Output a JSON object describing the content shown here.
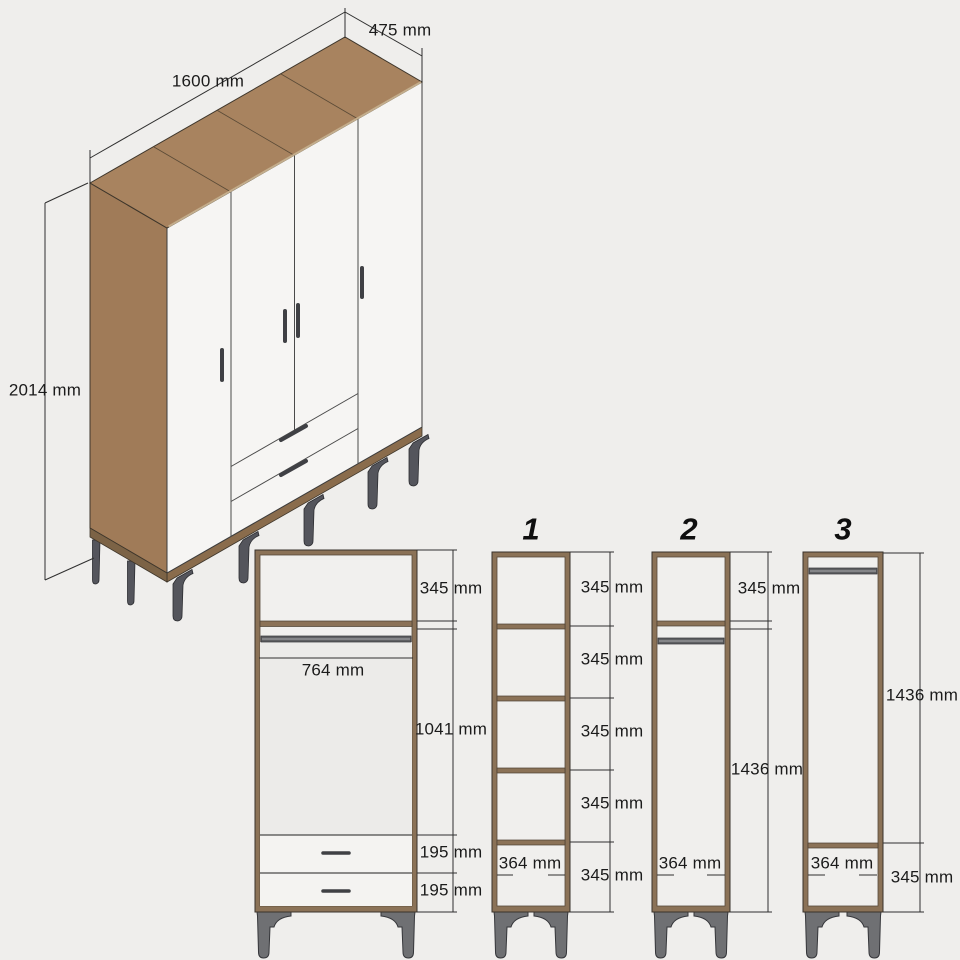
{
  "drawing_title": "wardrobe-dimension-drawing",
  "colors": {
    "background": "#efeeec",
    "wood_top": "#a8835f",
    "wood_side": "#a07b58",
    "wood_frame": "#8b7257",
    "panel_white": "#f6f5f3",
    "metal_gray": "#6f7073",
    "rail_gray": "#5f6063",
    "dimension_line": "#2f2f2f"
  },
  "iso_view": {
    "width": "1600 mm",
    "depth": "475 mm",
    "height": "2014 mm"
  },
  "front_view": {
    "top_section": "345 mm",
    "inner_width": "764 mm",
    "middle_section": "1041 mm",
    "drawer_1": "195 mm",
    "drawer_2": "195 mm"
  },
  "column_1": {
    "title": "1",
    "sections": [
      "345 mm",
      "345 mm",
      "345 mm",
      "345 mm",
      "345 mm"
    ],
    "inner_width": "364 mm"
  },
  "column_2": {
    "title": "2",
    "top_section": "345 mm",
    "open_section": "1436 mm",
    "inner_width": "364 mm"
  },
  "column_3": {
    "title": "3",
    "open_section": "1436 mm",
    "bottom_section": "345 mm",
    "inner_width": "364 mm"
  }
}
